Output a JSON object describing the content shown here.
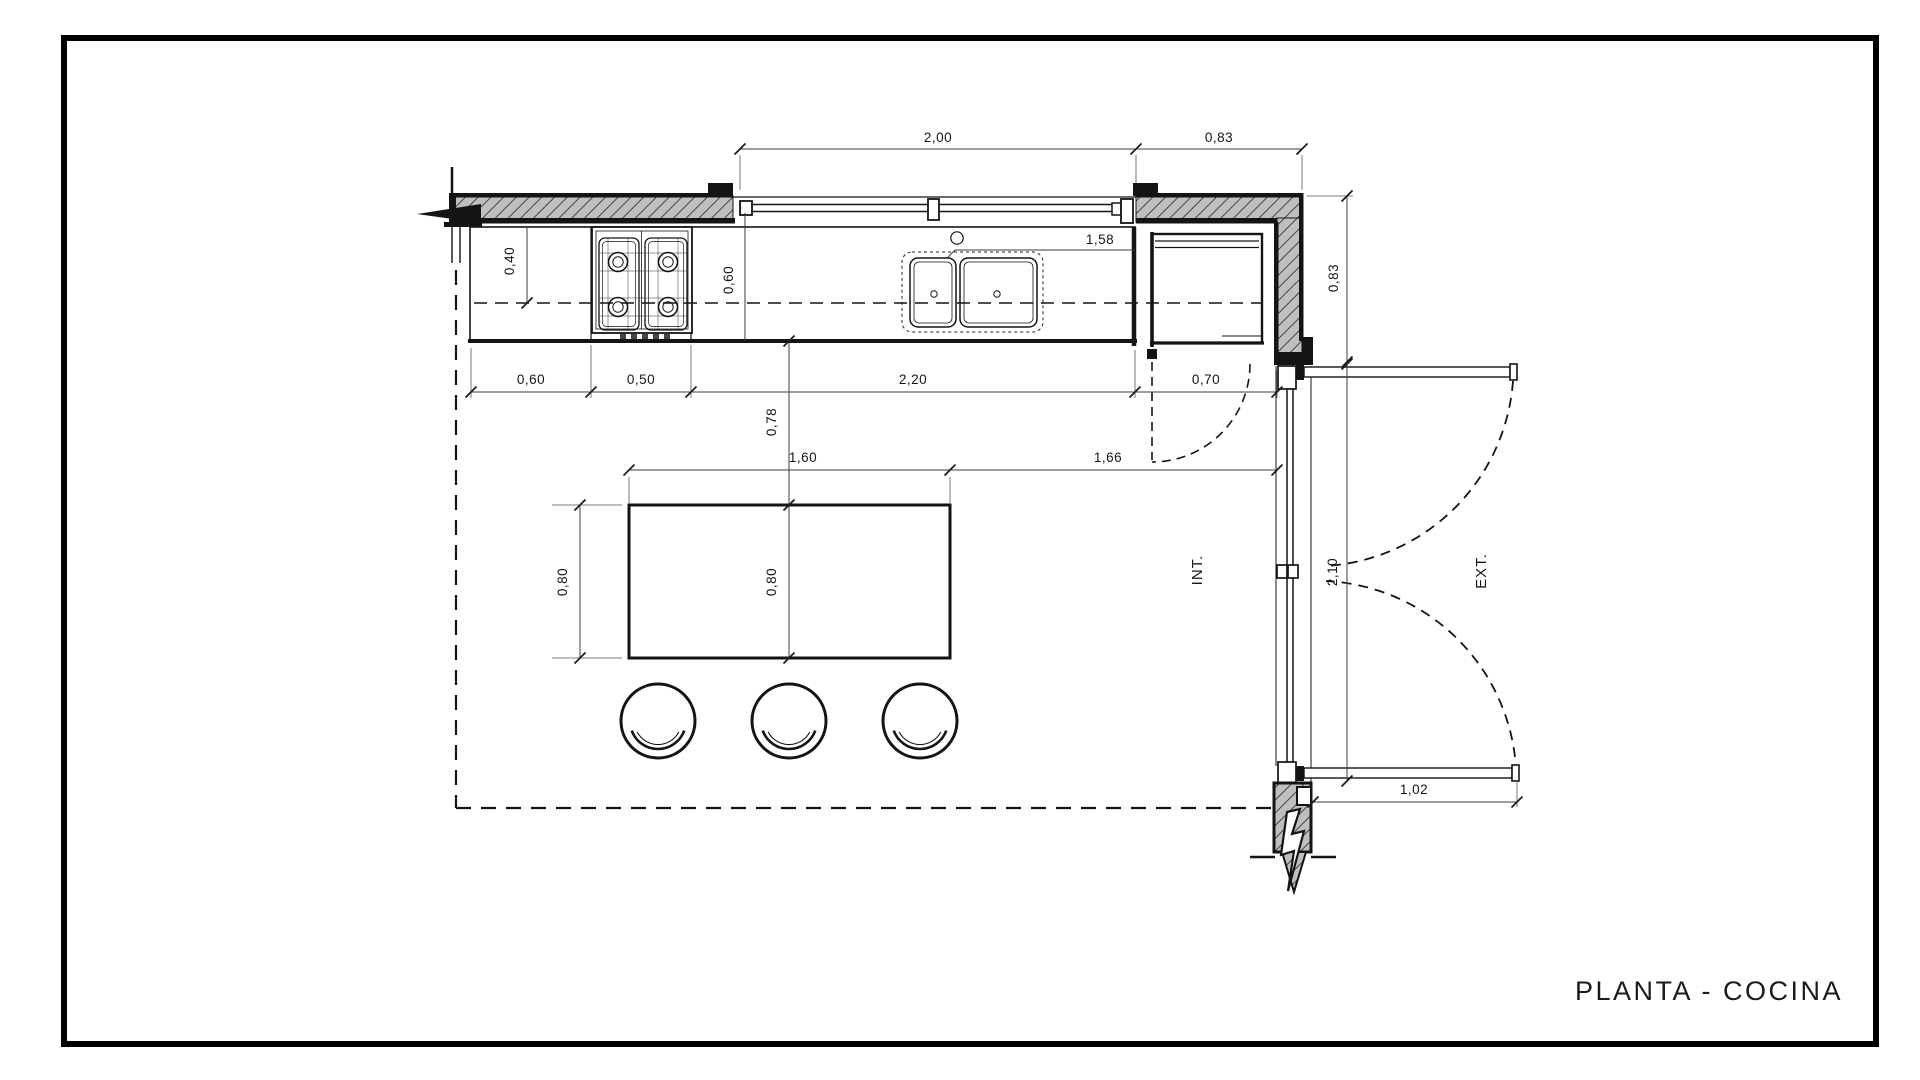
{
  "plan": {
    "title": "PLANTA - COCINA",
    "zones": {
      "interior": "INT.",
      "exterior": "EXT."
    },
    "dims": {
      "window_top": "2,00",
      "corner_top": "0,83",
      "corner_right": "0,83",
      "sink_to_corner": "1,58",
      "wall_to_axis": "0,40",
      "counter_depth": "0,60",
      "cabinet_left": "0,60",
      "stove_width": "0,50",
      "counter_run": "2,20",
      "door_opening": "0,70",
      "counter_to_table": "0,78",
      "table_length": "1,60",
      "table_to_window": "1,66",
      "table_width": "0,80",
      "table_width_axis": "0,80",
      "window_height": "2,10",
      "window_leaf": "1,02"
    }
  }
}
